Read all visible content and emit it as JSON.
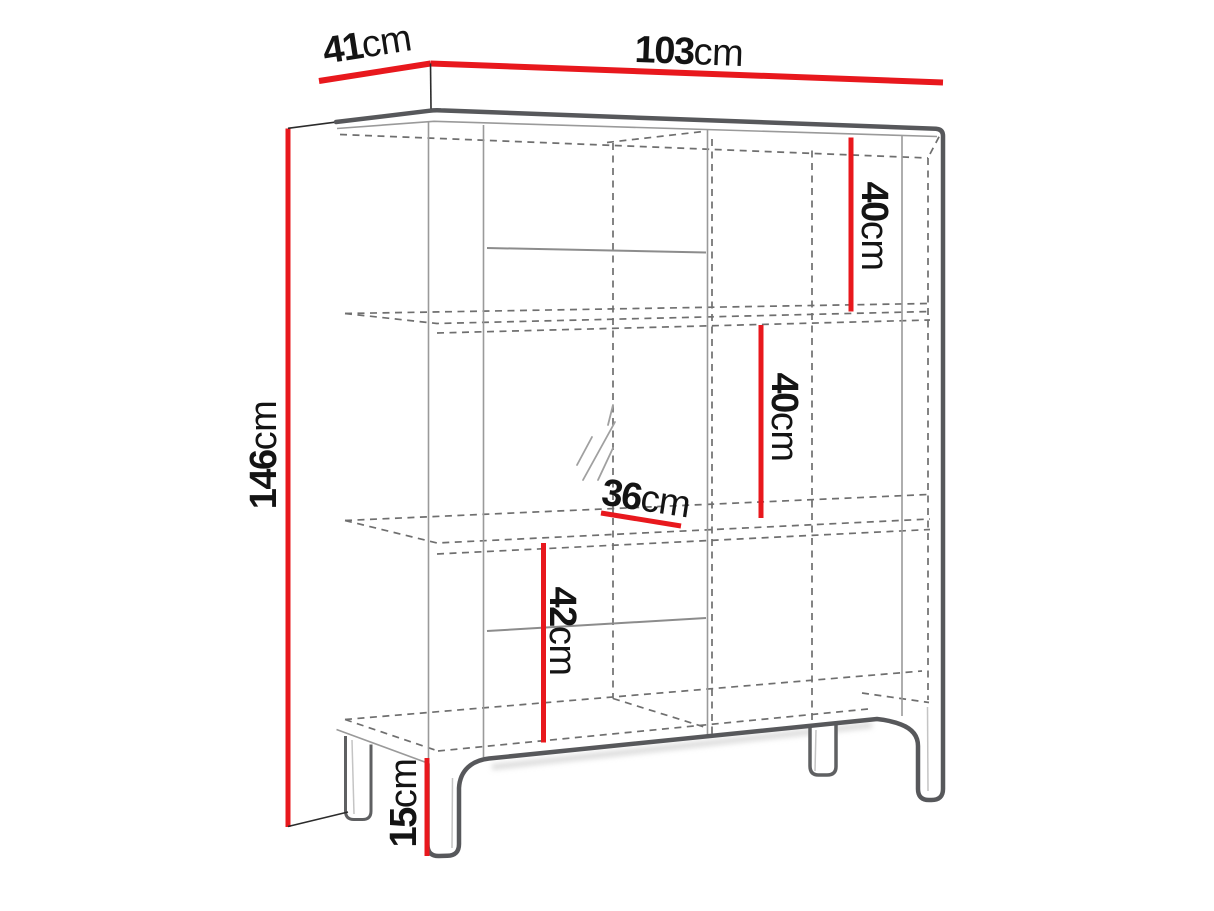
{
  "diagram": {
    "type": "furniture-dimension-drawing",
    "unit": "cm",
    "colors": {
      "dimension_line": "#e8181d",
      "outline": "#57585b",
      "hidden_edge": "#6f6f6f",
      "label_text": "#141414",
      "background": "#ffffff"
    },
    "labels": {
      "width": {
        "value": "103",
        "unit": "cm"
      },
      "depth": {
        "value": "41",
        "unit": "cm"
      },
      "height": {
        "value": "146",
        "unit": "cm"
      },
      "upper_shelf": {
        "value": "40",
        "unit": "cm"
      },
      "middle_shelf": {
        "value": "40",
        "unit": "cm"
      },
      "inner_width": {
        "value": "36",
        "unit": "cm"
      },
      "lower_shelf": {
        "value": "42",
        "unit": "cm"
      },
      "legs": {
        "value": "15",
        "unit": "cm"
      }
    }
  }
}
